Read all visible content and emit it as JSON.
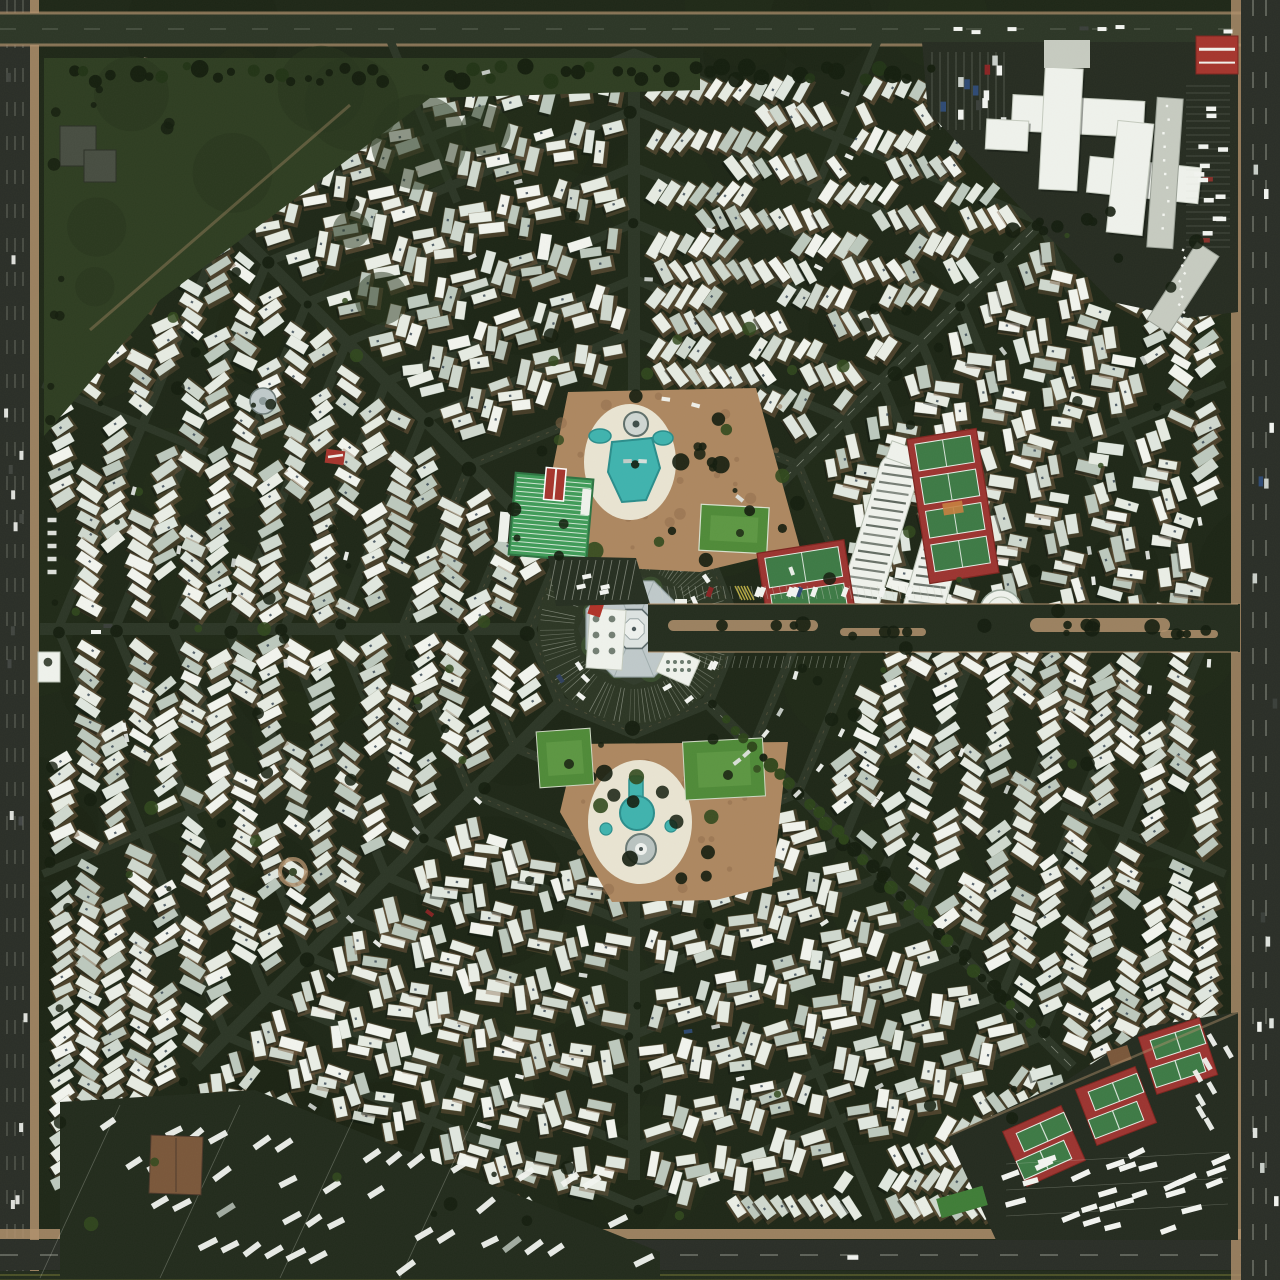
{
  "image": {
    "kind": "aerial-satellite-photograph",
    "subject": "octagonal spiderweb trailer-park community viewed from directly overhead",
    "notable_parts": [
      "central octagonal community building",
      "north pool plaza",
      "south pool plaza",
      "shuffleboard courts",
      "lawn-bowling green",
      "covered parking canopies",
      "tennis courts east",
      "tennis courts southeast corner",
      "rv storage lot southwest corner",
      "office complex northeast corner",
      "perimeter highways",
      "concentric ring streets with white mobile homes"
    ]
  },
  "canvas": {
    "w": 1280,
    "h": 1280
  },
  "palette": {
    "ground": "#1e2717",
    "groundDark": "#161e10",
    "road": "#2c3626",
    "roadDark": "#222b1c",
    "curbTan": "#8a7454",
    "sidewalk": "#b0906c",
    "plaza": "#ad8760",
    "deck": "#e9e4d2",
    "pool": "#3fb3ae",
    "poolEdge": "#2a8d8b",
    "trailers": [
      "#eaeee6",
      "#e0e7df",
      "#f2f4ee",
      "#cfd8ce",
      "#bcc8bd",
      "#e6ebe2"
    ],
    "pad": "#7a5c40",
    "shadow": "#0b110a",
    "acDot": "#31404e",
    "treeDark": "#141d0e",
    "treeLight": "#31491d",
    "grassPark": "#2e3d21",
    "lawn": "#4f8a38",
    "lawnLight": "#69a24c",
    "shuffleGreen": "#3f9b58",
    "courtRed": "#9c3430",
    "courtGreen": "#3d7a45",
    "lineWhite": "#e7eee7",
    "roofGray": "#bfc9ca",
    "roofLight": "#dde3e1",
    "roofEdge": "#8e9c9c",
    "buildingWhite": "#eff2ec",
    "buildingGray": "#c6cbc0",
    "redRoof": "#a6352d",
    "brownRoof": "#7a573a",
    "carWhite": "#f2f4f0",
    "laneWhite": "#cfd3c6",
    "laneYellow": "#8f8f3a",
    "hwy": "#2a2e27"
  },
  "web": {
    "cx": 634,
    "cy": 629,
    "spokesDeg": [
      0,
      45,
      90,
      135,
      180,
      225,
      270,
      315
    ],
    "rings": [
      104,
      168,
      232,
      297,
      350,
      406,
      462,
      519,
      576
    ],
    "outerR": 960,
    "clip": {
      "x0": 46,
      "y0": 58,
      "x1": 1232,
      "y1": 1228
    },
    "sectorRowDir": [
      "v",
      "bs",
      "fs",
      "v",
      "v",
      "bs",
      "h",
      "fs"
    ],
    "innerTrailerSectors": [
      3,
      4
    ],
    "halfSpokeMinR": 462,
    "rowPitch": 26,
    "unitPitch": 14.5,
    "seed": 20150317,
    "treeLinedSpoke": 45
  },
  "perimeter": {
    "left": {
      "x": 0,
      "w": 30,
      "shoulderX": 30,
      "shoulderW": 9
    },
    "top": {
      "y": 13,
      "h": 32
    },
    "bottom": {
      "sidewalkY": 1229,
      "roadY": 1240,
      "roadH": 30,
      "edgeY": 1271
    },
    "right": {
      "medianX": 1231,
      "x": 1241,
      "w": 39
    }
  },
  "features": {
    "center": {
      "plazaR": 96,
      "ringRoadR": 104,
      "roofR": 52,
      "innerOctR": 21,
      "coreR": 11,
      "wing": {
        "x": 588,
        "y": 639,
        "w": 36,
        "h": 60,
        "rot": 4
      },
      "redCanopy": {
        "x": 597,
        "y": 605,
        "w": 13,
        "h": 22,
        "rot": 18
      },
      "annexSE": {
        "x": 678,
        "y": 666,
        "w": 36,
        "h": 28,
        "rot": 24
      },
      "annexE": {
        "x": 681,
        "y": 608,
        "w": 12,
        "h": 18,
        "rot": 0
      }
    },
    "northPark": {
      "poly": [
        [
          568,
          392
        ],
        [
          756,
          388
        ],
        [
          800,
          548
        ],
        [
          700,
          572
        ],
        [
          586,
          566
        ],
        [
          548,
          492
        ]
      ],
      "deck": {
        "cx": 630,
        "cy": 462,
        "rx": 46,
        "ry": 58
      },
      "pool": [
        [
          612,
          442
        ],
        [
          652,
          438
        ],
        [
          660,
          468
        ],
        [
          646,
          500
        ],
        [
          622,
          502
        ],
        [
          608,
          472
        ]
      ],
      "ovals": [
        [
          600,
          436,
          11,
          7
        ],
        [
          663,
          438,
          10,
          7
        ]
      ],
      "fountain": {
        "cx": 636,
        "cy": 424,
        "r": 12
      }
    },
    "shuffleboard": {
      "x": 512,
      "y": 476,
      "w": 78,
      "h": 82,
      "rot": 5,
      "stripes": 18,
      "clubhouse": {
        "x": 542,
        "y": 468,
        "w": 20,
        "h": 32
      }
    },
    "bowlingGreen": {
      "x": 700,
      "y": 506,
      "w": 68,
      "h": 46,
      "rot": 3
    },
    "shuffleParking": {
      "poly": [
        [
          548,
          556
        ],
        [
          636,
          558
        ],
        [
          650,
          604
        ],
        [
          556,
          606
        ]
      ],
      "stripes": 11
    },
    "southPark": {
      "poly": [
        [
          576,
          744
        ],
        [
          788,
          742
        ],
        [
          772,
          886
        ],
        [
          716,
          900
        ],
        [
          612,
          902
        ],
        [
          560,
          812
        ]
      ],
      "deck": {
        "cx": 640,
        "cy": 822,
        "rx": 52,
        "ry": 62
      },
      "poolNeck": {
        "x": 629,
        "y": 776,
        "w": 14,
        "h": 28
      },
      "poolR": 17,
      "poolCx": 637,
      "poolCy": 813,
      "roundBldg": {
        "cx": 641,
        "cy": 849,
        "r": 15
      },
      "spas": [
        [
          606,
          829,
          6
        ],
        [
          671,
          826,
          6
        ]
      ]
    },
    "southLawns": [
      {
        "x": 538,
        "y": 730,
        "w": 54,
        "h": 56,
        "rot": -4
      },
      {
        "x": 684,
        "y": 740,
        "w": 80,
        "h": 58,
        "rot": -3
      }
    ],
    "canopies": [
      {
        "cx": 878,
        "cy": 540,
        "w": 40,
        "h": 182,
        "rot": 17
      },
      {
        "cx": 941,
        "cy": 546,
        "w": 40,
        "h": 180,
        "rot": 16
      }
    ],
    "tennisNE": {
      "cx": 953,
      "cy": 506,
      "w": 70,
      "h": 146,
      "rot": -9,
      "courts": 4
    },
    "tennisW": {
      "cx": 807,
      "cy": 588,
      "w": 88,
      "h": 84,
      "rot": -9,
      "courts": 2
    },
    "roundBuilding": {
      "cx": 1001,
      "cy": 611,
      "r": 21
    },
    "eastEntrance": {
      "road": {
        "x": 648,
        "y": 604,
        "w": 592,
        "h": 48
      },
      "medians": [
        [
          668,
          620,
          150,
          11
        ],
        [
          840,
          628,
          86,
          8
        ],
        [
          1030,
          618,
          140,
          14
        ],
        [
          1160,
          630,
          58,
          8
        ]
      ],
      "stallRow": {
        "x0": 660,
        "x1": 950,
        "y": 586
      }
    },
    "topLeftPark": {
      "poly": [
        [
          44,
          58
        ],
        [
          700,
          58
        ],
        [
          700,
          90
        ],
        [
          430,
          98
        ],
        [
          160,
          300
        ],
        [
          44,
          436
        ]
      ],
      "buildings": [
        [
          60,
          126,
          36,
          40
        ],
        [
          84,
          150,
          32,
          32
        ]
      ],
      "pavilion": {
        "cx": 263,
        "cy": 401,
        "r": 13
      },
      "redCottage": {
        "x": 326,
        "y": 450,
        "w": 19,
        "h": 14
      }
    },
    "roundabout": {
      "cx": 293,
      "cy": 872,
      "r": 13
    },
    "bottomLeftStorage": {
      "poly": [
        [
          60,
          1102
        ],
        [
          255,
          1090
        ],
        [
          660,
          1252
        ],
        [
          660,
          1276
        ],
        [
          60,
          1276
        ]
      ],
      "building": {
        "x": 150,
        "y": 1136,
        "w": 52,
        "h": 58
      },
      "rvRows": [
        1124,
        1160,
        1196,
        1232
      ],
      "rvX0": 108,
      "rvX1": 648
    },
    "topRightComplex": {
      "poly": [
        [
          922,
          42
        ],
        [
          1238,
          42
        ],
        [
          1238,
          312
        ],
        [
          1188,
          318
        ],
        [
          1112,
          302
        ],
        [
          928,
          112
        ]
      ],
      "crossRects": [
        [
          1012,
          98,
          132,
          36,
          3
        ],
        [
          1042,
          68,
          38,
          122,
          3
        ],
        [
          1088,
          162,
          112,
          36,
          6
        ],
        [
          1112,
          122,
          36,
          112,
          6
        ],
        [
          986,
          120,
          42,
          30,
          3
        ]
      ],
      "grayAnnex": [
        1044,
        40,
        46,
        28
      ],
      "strip": [
        [
          1152,
          98,
          26,
          150,
          4
        ],
        [
          1170,
          242,
          26,
          92,
          33
        ]
      ],
      "redBuilding": {
        "x": 1196,
        "y": 36,
        "w": 42,
        "h": 38
      },
      "parkingTL": {
        "x0": 932,
        "y0": 52,
        "x1": 1006,
        "y1": 130
      },
      "parkingR": {
        "x0": 1186,
        "y0": 86,
        "x1": 1230,
        "y1": 252
      }
    },
    "bottomRightTennis": {
      "poly": [
        [
          948,
          1136
        ],
        [
          1064,
          1082
        ],
        [
          1150,
          1026
        ],
        [
          1238,
          1012
        ],
        [
          1238,
          1240
        ],
        [
          996,
          1240
        ]
      ],
      "pairs": [
        {
          "cx": 1178,
          "cy": 1056,
          "rot": -18
        },
        {
          "cx": 1116,
          "cy": 1106,
          "rot": -21
        },
        {
          "cx": 1044,
          "cy": 1146,
          "rot": -24
        }
      ],
      "pairSize": {
        "w": 64,
        "h": 60,
        "courtW": 52,
        "courtH": 20
      },
      "brownShed": {
        "x": 1108,
        "y": 1048,
        "w": 22,
        "h": 15
      },
      "greenStrip": {
        "x": 938,
        "y": 1192,
        "w": 48,
        "h": 20,
        "rot": -16
      },
      "rvArea": {
        "x0": 1006,
        "y0": 1150,
        "x1": 1228,
        "y1": 1232
      }
    },
    "westGateBuilding": {
      "x": 38,
      "y": 652,
      "w": 22,
      "h": 30
    }
  },
  "trees": {
    "scatterCount": 170,
    "topRow": {
      "x0": 56,
      "x1": 935,
      "y": 66,
      "pitch": 13
    }
  },
  "cars": {
    "ringCount": 60,
    "colors": [
      "#f2f4f0",
      "#dfe3de",
      "#c9cfc9",
      "#8a2424",
      "#2e4a74",
      "#3a3f3a"
    ]
  }
}
